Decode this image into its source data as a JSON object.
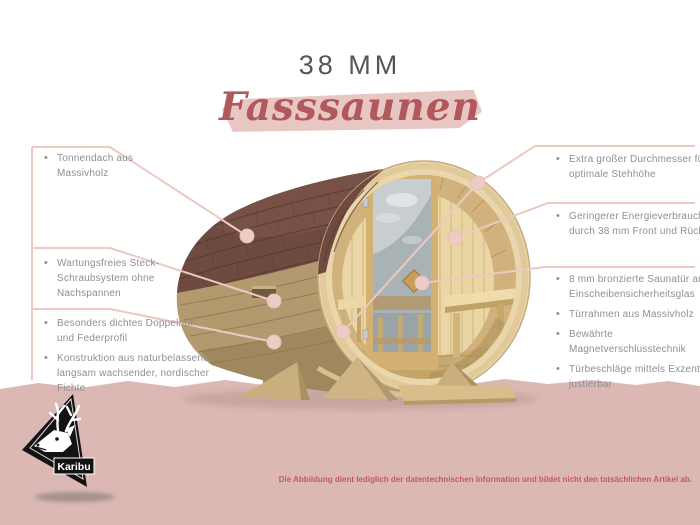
{
  "header": {
    "size_label": "38 MM",
    "title": "Fasssaunen",
    "title_color": "#b0585c",
    "highlight_color": "#e7c6c3"
  },
  "callouts": {
    "left": [
      {
        "items": [
          "Tonnendach aus\nMassivholz"
        ]
      },
      {
        "items": [
          "Wartungsfreies Steck-\nSchraubsystem ohne\nNachspannen"
        ]
      },
      {
        "items": [
          "Besonders dichtes Doppelnut-\nund Federprofil",
          "Konstruktion aus naturbelassener,\nlangsam wachsender, nordischer\nFichte"
        ]
      }
    ],
    "right": [
      {
        "items": [
          "Extra großer Durchmesser für eine\noptimale Stehhöhe"
        ]
      },
      {
        "items": [
          "Geringerer Energieverbrauch\ndurch 38 mm Front und Rückwand"
        ]
      },
      {
        "items": [
          "8 mm bronzierte Saunatür aus\nEinscheibensicherheitsglas",
          "Türrahmen aus Massivholz",
          "Bewährte Magnetverschlusstechnik",
          "Türbeschläge mittels Exzenter\njustierbar"
        ]
      }
    ]
  },
  "footer": {
    "disclaimer": "Die Abbildung dient lediglich der datentechnischen Information und bildet nicht den tatsächlichen Artikel ab."
  },
  "logo": {
    "brand": "Karibu"
  },
  "accent": {
    "line_color": "#ecc9c2",
    "dot_color": "#eeccc5",
    "callout_text_color": "#8f8f90",
    "band_color": "#dbb8b4",
    "disclaimer_color": "#c05a66"
  }
}
